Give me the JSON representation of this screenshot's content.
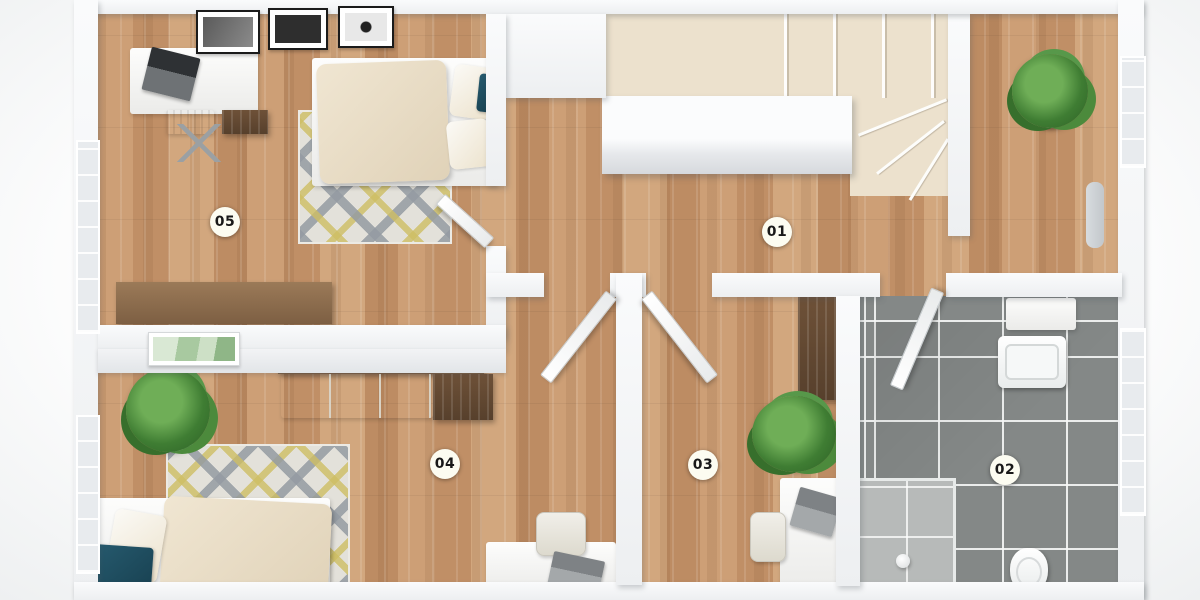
{
  "scene": {
    "title": "3D floor plan – upper storey, top-down view",
    "label_style": "numbered circular badges"
  },
  "rooms": [
    {
      "label": "01"
    },
    {
      "label": "02"
    },
    {
      "label": "03"
    },
    {
      "label": "04"
    },
    {
      "label": "05"
    }
  ],
  "colors": {
    "wood_floor": "#c89a71",
    "bathroom_tile": "#848887",
    "wall_white": "#f2f3f5",
    "stair_cream": "#ece1cd",
    "rug_gray": "#959ba2",
    "rug_yellow": "#cebe63",
    "duvet_cream": "#e8dcc2",
    "accent_teal": "#1e4f63",
    "plant_green": "#3f7d33",
    "sideboard_brown": "#8a6a4e",
    "wardrobe_dark_brown": "#5d4433",
    "label_bg": "#fcfcf1",
    "label_text": "#191919"
  }
}
